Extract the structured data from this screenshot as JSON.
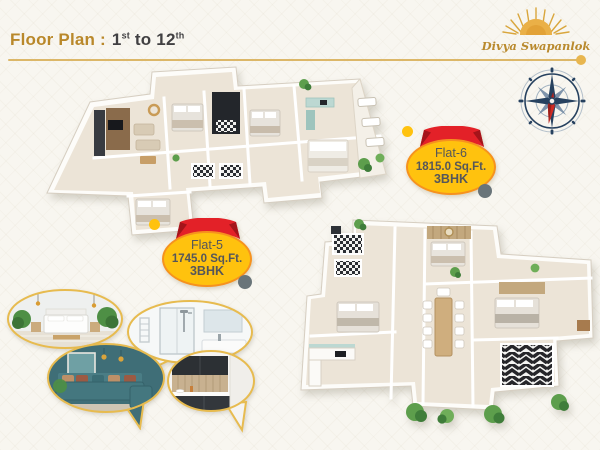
{
  "header": {
    "title": "Floor Plan :",
    "floor_from": "1",
    "floor_from_sup": "st",
    "connector": "to",
    "floor_to": "12",
    "floor_to_sup": "th"
  },
  "logo": {
    "brand": "Divya Swapanlok"
  },
  "badges": {
    "flat6": {
      "name": "Flat-6",
      "area": "1815.0 Sq.Ft.",
      "config": "3BHK"
    },
    "flat5": {
      "name": "Flat-5",
      "area": "1745.0 Sq.Ft.",
      "config": "3BHK"
    }
  },
  "colors": {
    "heading_gold": "#b9882a",
    "rule_gold": "#dcb768",
    "badge_yellow": "#ffc20e",
    "badge_border_orange": "#f6921e",
    "ribbon_red": "#e32128",
    "dot_gray": "#697479",
    "compass_navy": "#26415f",
    "compass_red": "#cf2b24",
    "sofa_teal": "#44777f"
  }
}
